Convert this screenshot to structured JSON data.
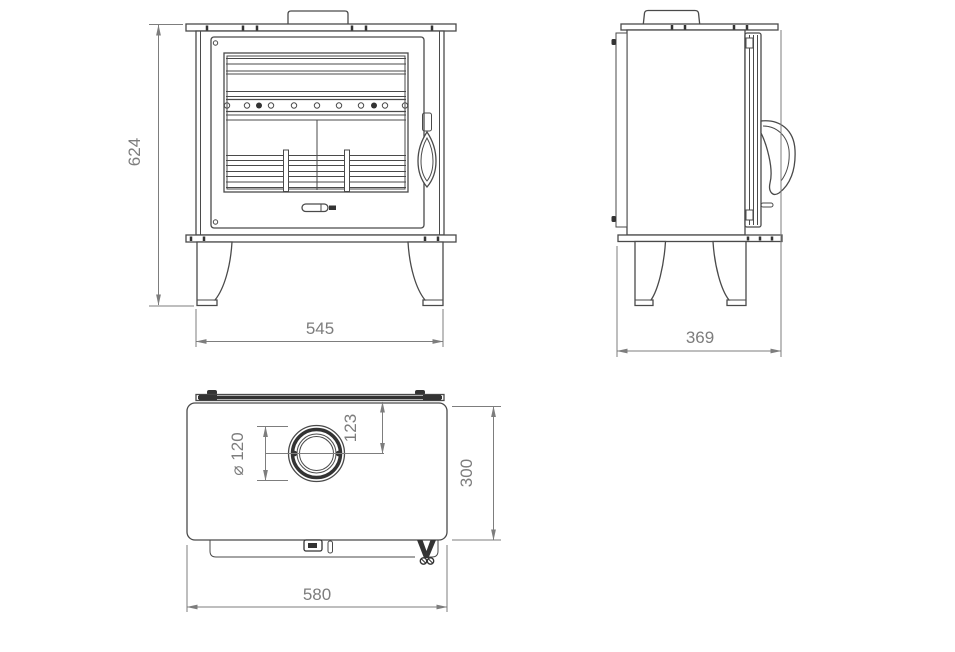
{
  "drawing": {
    "dimensions": {
      "front_height": "624",
      "front_width": "545",
      "side_depth": "369",
      "flue_diameter": "⌀ 120",
      "flue_center_offset": "123",
      "top_depth": "300",
      "top_width": "580"
    },
    "colors": {
      "line": "#4a4a4a",
      "dark": "#333333",
      "dimension": "#7d7d7d",
      "background": "#ffffff"
    }
  }
}
